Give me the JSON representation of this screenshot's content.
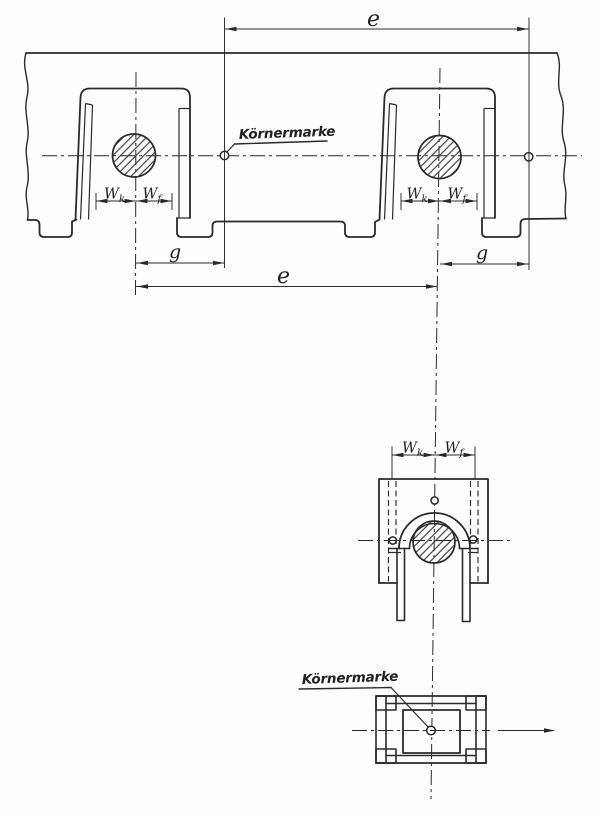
{
  "drawing": {
    "labels": {
      "koernermarke_top": "Körnermarke",
      "koernermarke_bottom": "Körnermarke",
      "e_top": "e",
      "e_bottom": "e",
      "g_left": "g",
      "g_right": "g",
      "w_base": "W",
      "sub_k": "k",
      "sub_f": "f"
    },
    "colors": {
      "ink": "#2a2a2a",
      "paper": "#fdfdfc"
    }
  }
}
